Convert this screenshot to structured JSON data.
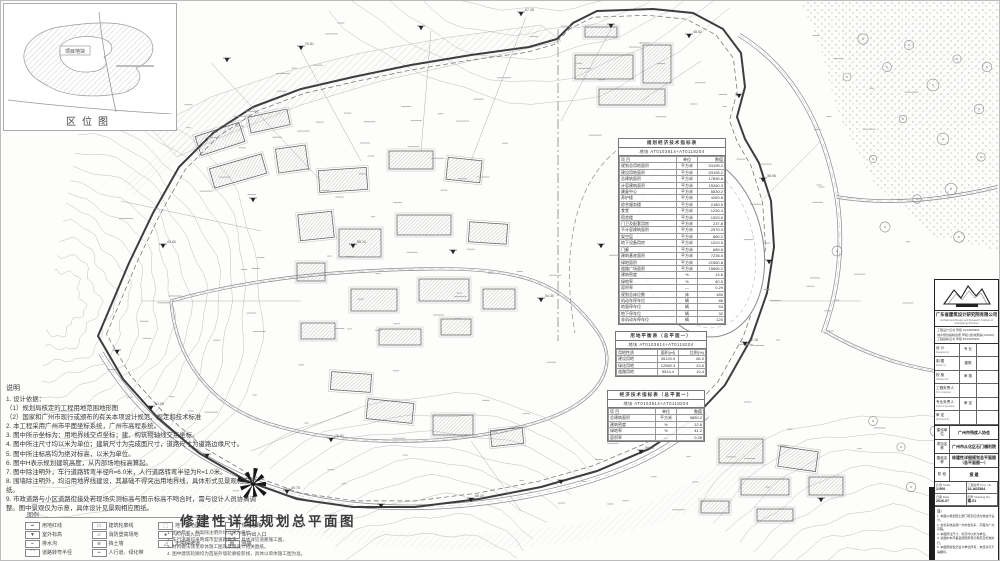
{
  "location_map": {
    "caption": "区位图",
    "site_label": "项目地块"
  },
  "notes": {
    "title": "说明",
    "items": [
      "1. 设计依据：",
      "（1）规划局核定的工程用地范围地形图",
      "（2）国家和广州市现行或颁布的有关本项设计规范、规定和技术标准",
      "2. 本工程采用广州市平面坐标系统，广州市高程系统。",
      "3. 图中所示坐标为：用地界线交点坐标；建、构筑物轴线交点坐标。",
      "4. 图中所注尺寸均以米为单位；建筑尺寸为完成面尺寸，道路尺寸为道路边缘尺寸。",
      "5. 图中所注标高均为绝对标高，以米为单位。",
      "6. 图中H表示规划建筑高度，从内部场地标高算起。",
      "7. 图中除注明外，车行道路转弯半径R=6.0米，人行道路转弯半径为R=1.0米。",
      "8. 围墙除注明外，均沿用地界线建设，其基础不得突出用地界线，具体形式见景观相应图纸。",
      "9. 市政道路与小区道路衔接处若现场实测标高与图示标高不吻合时，需与设计人员协商调整。图中景观仅为示意，具体设计见景观相应图纸。"
    ]
  },
  "legend": {
    "title": "图例",
    "items": [
      {
        "glyph": "━",
        "label": "用地红线"
      },
      {
        "glyph": "▭",
        "label": "建筑轮廓线"
      },
      {
        "glyph": "⬚",
        "label": "地下室范围线"
      },
      {
        "glyph": "═",
        "label": "规划道路"
      },
      {
        "glyph": "▼",
        "label": "室外标高"
      },
      {
        "glyph": "▱",
        "label": "消防登高场地"
      },
      {
        "glyph": "●",
        "label": "人行出入口"
      },
      {
        "glyph": "▾",
        "label": "车行出入口"
      },
      {
        "glyph": "┉",
        "label": "排水沟"
      },
      {
        "glyph": "≋",
        "label": "挡土墙"
      },
      {
        "glyph": "◿",
        "label": "无障碍坡道"
      },
      {
        "glyph": "▨",
        "label": "围墙"
      },
      {
        "glyph": "⌒",
        "label": "道路转弯半径"
      },
      {
        "glyph": "┅",
        "label": "人行道、绿化带"
      }
    ]
  },
  "main_title": {
    "text": "修建性详细规划总平面图",
    "notes": [
      "1. 图中尺寸、标高除注明外均以米为单位。",
      "2. 车行道路均采用城市型道路做法，具体详见道路施工图。",
      "3. 材料做法详见单体施工图及景观设计相关图纸。",
      "4. 图中建筑轮廓均为首层外墙轮廓投影线，具体以单体施工图为准。"
    ]
  },
  "indicator_table": {
    "title": "规划经济技术指标表",
    "subtitle": "地块 AT0103614+AT0118204",
    "columns": [
      "项 目",
      "单位",
      "数值"
    ],
    "rows": [
      [
        "规划总用地面积",
        "平方米",
        "53195.2"
      ],
      [
        "建设用地面积",
        "平方米",
        "53195.2"
      ],
      [
        "总建筑面积",
        "平方米",
        "17830.6"
      ],
      [
        "计容建筑面积",
        "平方米",
        "15260.3"
      ],
      [
        "康复中心",
        "平方米",
        "5830.2"
      ],
      [
        "养护楼",
        "平方米",
        "4260.8"
      ],
      [
        "综合服务楼",
        "平方米",
        "2180.5"
      ],
      [
        "食堂",
        "平方米",
        "1230.4"
      ],
      [
        "宿舍楼",
        "平方米",
        "1520.6"
      ],
      [
        "门卫及配套用房",
        "平方米",
        "237.8"
      ],
      [
        "不计容建筑面积",
        "平方米",
        "2570.3"
      ],
      [
        "架空层",
        "平方米",
        "860.2"
      ],
      [
        "地下设备用房",
        "平方米",
        "1020.5"
      ],
      [
        "门廊",
        "平方米",
        "689.6"
      ],
      [
        "建筑基底面积",
        "平方米",
        "7236.5"
      ],
      [
        "绿地面积",
        "平方米",
        "21560.8"
      ],
      [
        "道路广场面积",
        "平方米",
        "15890.2"
      ],
      [
        "建筑密度",
        "%",
        "13.6"
      ],
      [
        "绿地率",
        "%",
        "40.5"
      ],
      [
        "容积率",
        "—",
        "0.29"
      ],
      [
        "规划总床位数",
        "床",
        "450"
      ],
      [
        "机动车停车位",
        "辆",
        "86"
      ],
      [
        "地面停车位",
        "辆",
        "54"
      ],
      [
        "地下停车位",
        "辆",
        "32"
      ],
      [
        "非机动车停车位",
        "辆",
        "120"
      ]
    ]
  },
  "sub_tables": [
    {
      "title": "用地平衡表（总平面一）",
      "subtitle": "地块 AT0103614+AT0118204",
      "rows": [
        [
          "用地性质",
          "面积(㎡)",
          "比例(%)"
        ],
        [
          "建设用地",
          "35120.5",
          "66.0"
        ],
        [
          "绿化用地",
          "12560.3",
          "23.6"
        ],
        [
          "道路用地",
          "5514.4",
          "10.4"
        ]
      ]
    },
    {
      "title": "经济技术指标表（总平面一）",
      "subtitle": "地块 AT0103614+AT0118204",
      "rows": [
        [
          "项 目",
          "单位",
          "数值"
        ],
        [
          "总建筑面积",
          "平方米",
          "9830.2"
        ],
        [
          "建筑密度",
          "%",
          "12.8"
        ],
        [
          "绿地率",
          "%",
          "41.2"
        ],
        [
          "容积率",
          "—",
          "0.26"
        ]
      ]
    }
  ],
  "titleblock": {
    "company": "广东省建筑设计研究院有限公司",
    "company_en": "Architectural Design and Research Institute of Guangdong Province",
    "cert_lines": [
      "工程设计证书 甲级 A144005961",
      "城乡规划编制资质 甲级 [建]城规编(141060)",
      "工程勘察证书 甲级 B144005961"
    ],
    "staff_rows": [
      {
        "cn": "设  计",
        "en": "Designed by",
        "mid": "专 业"
      },
      {
        "cn": "制  图",
        "en": "Drawn by",
        "mid": "建筑"
      },
      {
        "cn": "校  核",
        "en": "Checked by",
        "mid": "审 核"
      },
      {
        "cn": "工程负责人",
        "en": "Proj. Engineer",
        "mid": ""
      },
      {
        "cn": "专业负责人",
        "en": "Chief of Specialty",
        "mid": "审 定"
      },
      {
        "cn": "审  定",
        "en": "Approved by",
        "mid": ""
      }
    ],
    "project_rows": [
      {
        "label": "建设单位",
        "value": "广州市残疾人协会"
      },
      {
        "label": "项目名称",
        "value": "广州市从化区石门福利院"
      },
      {
        "label": "图纸名称",
        "value": "修建性详细规划总平面图（总平面图一）"
      }
    ],
    "stage": {
      "label": "阶 段",
      "value": "报 建"
    },
    "meta": [
      {
        "label": "比例 Scale",
        "value": "1:500"
      },
      {
        "label": "工程编号 Proj. No.",
        "value": "16-A02584"
      },
      {
        "label": "日期 Date",
        "value": "2016.07"
      },
      {
        "label": "图号 Drawing No.",
        "value": "规-01"
      }
    ],
    "notes_title": "注：",
    "notes": [
      "1. 本图以规划国土部门核定红线为准进行设计。",
      "2. 坐标系统采用广州市坐标系，高程为广州高程。",
      "3. 本图所注尺寸、标高均以米为单位。",
      "4. 总图中未尽事宜按国家现行规范及标准执行。",
      "5. 本图纸版权归设计单位所有，未经许可不得翻印。"
    ]
  },
  "plan": {
    "spot_elevations": [
      "54.30",
      "70.81",
      "67.35",
      "45.62",
      "38.95",
      "72.16",
      "58.40",
      "66.20",
      "49.75",
      "61.08",
      "43.60",
      "55.12"
    ]
  }
}
